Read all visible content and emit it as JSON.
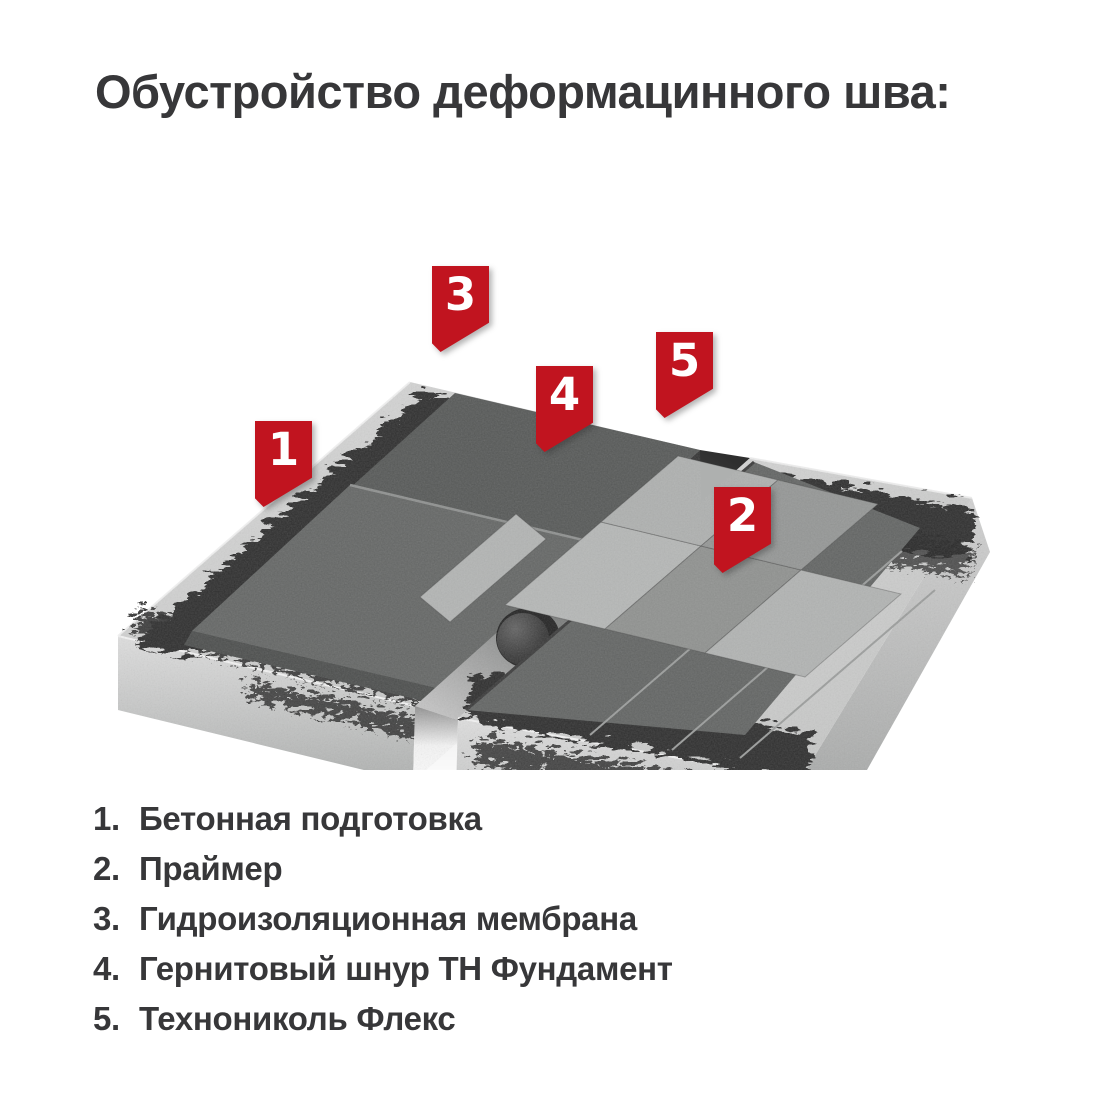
{
  "title": "Обустройство деформацинного шва:",
  "markers": [
    {
      "number": "1"
    },
    {
      "number": "2"
    },
    {
      "number": "3"
    },
    {
      "number": "4"
    },
    {
      "number": "5"
    }
  ],
  "legend": {
    "items": [
      {
        "number": "1.",
        "label": "Бетонная подготовка"
      },
      {
        "number": "2.",
        "label": "Праймер"
      },
      {
        "number": "3.",
        "label": "Гидроизоляционная мембрана"
      },
      {
        "number": "4.",
        "label": "Гернитовый шнур ТН Фундамент"
      },
      {
        "number": "5.",
        "label": "Технониколь Флекс"
      }
    ]
  },
  "colors": {
    "marker_red": "#c1141f",
    "text": "#373739",
    "concrete": "#cccccc",
    "primer_black": "#2d2d2d",
    "membrane_gray": "#5e605f",
    "flex_light": "#b4b6b5",
    "flex_medium": "#8f918f",
    "cord_dark": "#3a3a3a"
  }
}
